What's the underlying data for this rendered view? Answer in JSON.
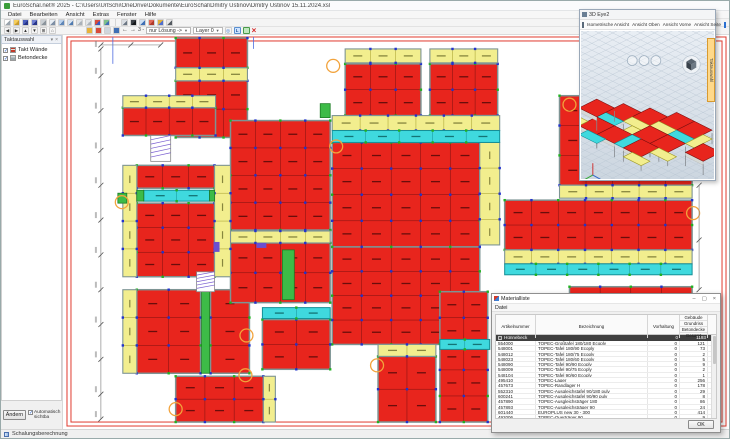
{
  "window": {
    "title": "EuroSchal.net® 2025 - C:\\Users\\UrlSchi\\OneDrive\\Dokumente\\EuroSchal\\Dmitry Ustinov\\Dmitry Ustinov 15.11.2024.xsl"
  },
  "menu": {
    "items": [
      "Datei",
      "Bearbeiten",
      "Ansicht",
      "Extras",
      "Fenster",
      "Hilfe"
    ]
  },
  "toolbar1": {
    "icons": [
      {
        "name": "new-file-icon",
        "c1": "#ffffff",
        "c2": "#9aa4ad"
      },
      {
        "name": "open-folder-icon",
        "c1": "#f7cf5e",
        "c2": "#c89a2a"
      },
      {
        "name": "save-icon",
        "c1": "#4a5fbe",
        "c2": "#27358a"
      },
      {
        "name": "save-all-icon",
        "c1": "#6f7fd0",
        "c2": "#27358a"
      },
      {
        "name": "print-icon",
        "c1": "#c9ced3",
        "c2": "#8b949c"
      },
      {
        "name": "print-preview-icon",
        "c1": "#e8eef4",
        "c2": "#7d8fa5"
      },
      {
        "name": "page-setup-icon",
        "c1": "#bcd3ee",
        "c2": "#5f86b8"
      },
      {
        "name": "export-icon",
        "c1": "#d7e2ef",
        "c2": "#4f7ab0"
      },
      {
        "name": "undo-icon",
        "c1": "#e3e6e9",
        "c2": "#aab2ba"
      },
      {
        "name": "redo-icon",
        "c1": "#e3e6e9",
        "c2": "#aab2ba"
      },
      {
        "name": "format-paint-icon",
        "c1": "#d94a3a",
        "c2": "#3a58c0"
      },
      {
        "name": "insert-image-icon",
        "c1": "#7fc08a",
        "c2": "#3f6fb5"
      },
      {
        "name": "sep",
        "c1": "",
        "c2": ""
      },
      {
        "name": "measure-icon",
        "c1": "#d9dde2",
        "c2": "#6b7683"
      },
      {
        "name": "select-cursor-icon",
        "c1": "#3a3f45",
        "c2": "#14171a"
      },
      {
        "name": "dimension-icon",
        "c1": "#cfe0f2",
        "c2": "#3f6fb5"
      },
      {
        "name": "snap-point-icon",
        "c1": "#e06a5a",
        "c2": "#b03a2a"
      },
      {
        "name": "takt-table-icon",
        "c1": "#e0b23a",
        "c2": "#4f6fd0"
      },
      {
        "name": "zoom-icon",
        "c1": "#e8e8e8",
        "c2": "#555b61"
      }
    ]
  },
  "toolbar2": {
    "nav_icons": [
      {
        "name": "pan-left-icon",
        "g": "◀"
      },
      {
        "name": "pan-right-icon",
        "g": "▶"
      },
      {
        "name": "pan-up-icon",
        "g": "▲"
      },
      {
        "name": "pan-down-icon",
        "g": "▼"
      },
      {
        "name": "zoom-window-icon",
        "g": "⊞"
      },
      {
        "name": "zoom-all-icon",
        "g": "⌂"
      }
    ],
    "takt_icons": [
      {
        "name": "takt-walls-icon",
        "c": "#e8b23a"
      },
      {
        "name": "takt-slab-icon",
        "c": "#d94a3a"
      },
      {
        "name": "pause-icon",
        "c": "#cfd6dd"
      },
      {
        "name": "view-mode-icon",
        "c": "#3f6fb5"
      }
    ],
    "prev_label": "←",
    "next_label": "→",
    "mode_label": "3 -",
    "solution_dropdown": "nur Lösung ->",
    "layer_dropdown": "Layer 0",
    "target_glyph": "◎",
    "solution_toggle": "L",
    "close_glyph": "×"
  },
  "sidebar": {
    "title": "Taktauswahl",
    "pin_glyph": "▾",
    "close_glyph": "×",
    "items": [
      {
        "label": "Takt Wände",
        "icon": "wall-icon",
        "checked": "✓"
      },
      {
        "label": "Betondecke",
        "icon": "slab-icon",
        "checked": "✓"
      }
    ],
    "change_button": "Ändern",
    "auto_checkbox": "Automatisch sichtba",
    "auto_checked": "✓"
  },
  "statusbar": {
    "text": "Schalungsberechnung"
  },
  "viewer3d": {
    "title": "3D Eye2",
    "toolbar": [
      "Isometrische Ansicht",
      "Ansicht Oben",
      "Ansicht Vorne",
      "Ansicht Seite"
    ],
    "side_tab": "Taktauswahl"
  },
  "materials": {
    "title": "Materialliste",
    "controls": {
      "min": "–",
      "max": "▢",
      "close": "×"
    },
    "menu": "Datei",
    "columns": {
      "art": "Artikelnummer",
      "bez": "Bezeichnung",
      "vor": "Vorhaltung"
    },
    "stacked_header": [
      "Gebäude",
      "Grundriss",
      "Betondecke",
      "Gesamt"
    ],
    "group": {
      "name": "Hünnebeck",
      "vorhaltung": "0",
      "gesamt": "1193"
    },
    "rows": [
      [
        "554000",
        "TOPEC-Großtafel 180/180 Ecoply",
        "0",
        "121"
      ],
      [
        "548001",
        "TOPEC-Tafel 180/90 Ecoply",
        "0",
        "73"
      ],
      [
        "548012",
        "TOPEC-Tafel 180/75 Ecoply",
        "0",
        "2"
      ],
      [
        "548023",
        "TOPEC-Tafel 180/60 Ecoply",
        "0",
        "5"
      ],
      [
        "548090",
        "TOPEC-Tafel 90/90 Ecoply",
        "0",
        "9"
      ],
      [
        "548009",
        "TOPEC-Tafel 90/75 Ecoply",
        "0",
        "2"
      ],
      [
        "548104",
        "TOPEC-Tafel 90/60 Ecoply",
        "0",
        "1"
      ],
      [
        "495410",
        "TOPEC-Lager",
        "0",
        "256"
      ],
      [
        "457673",
        "TOPEC-Randlager H",
        "0",
        "178"
      ],
      [
        "552310",
        "TOPEC-Ausgleichstafel 90/180 pulv",
        "0",
        "29"
      ],
      [
        "600241",
        "TOPEC-Ausgleichstafel 90/90 pulv",
        "0",
        "8"
      ],
      [
        "457890",
        "TOPEC-Ausgleichsträger 180",
        "0",
        "86"
      ],
      [
        "457893",
        "TOPEC-Ausgleichsträger 90",
        "0",
        "24"
      ],
      [
        "601440",
        "EUROPLUS new 30 - 300",
        "0",
        "414"
      ],
      [
        "492006",
        "TOPEC-Querträger 90",
        "0",
        "9"
      ]
    ],
    "ok": "OK"
  },
  "colors": {
    "red": "#e8251d",
    "redBorder": "#7a1010",
    "smudgeRed": "#4a0808",
    "yellow": "#f2ee8e",
    "yellowBorder": "#a09a28",
    "smudgeYellow": "#6b6b2a",
    "cyan": "#3fd9de",
    "cyanBorder": "#148f96",
    "smudgeCyan": "#0a5a5a",
    "green": "#3dbb47",
    "greenBorder": "#1d7d24",
    "wall": "#7d9494",
    "frame": "#e03a2e",
    "dotBlue": "#2233cc",
    "dotGreen": "#21b121",
    "orange": "#f2a33c",
    "purple": "#6a4fd0",
    "dim": "#8a8a8a"
  },
  "plan": {
    "frame": [
      [
        66,
        36,
        661,
        391
      ],
      [
        70,
        40,
        653,
        383
      ]
    ],
    "red_grids": [
      [
        175,
        37,
        72,
        30,
        3,
        1
      ],
      [
        175,
        80,
        72,
        57,
        3,
        2
      ],
      [
        122,
        107,
        93,
        28,
        4,
        1
      ],
      [
        136,
        165,
        78,
        23,
        3,
        1
      ],
      [
        136,
        203,
        78,
        74,
        3,
        3
      ],
      [
        136,
        290,
        64,
        84,
        2,
        3
      ],
      [
        210,
        290,
        39,
        84,
        1,
        3
      ],
      [
        230,
        120,
        100,
        110,
        4,
        4
      ],
      [
        230,
        243,
        100,
        60,
        4,
        2
      ],
      [
        175,
        377,
        88,
        46,
        3,
        2
      ],
      [
        345,
        63,
        76,
        52,
        3,
        2
      ],
      [
        430,
        63,
        68,
        52,
        3,
        2
      ],
      [
        332,
        142,
        148,
        105,
        5,
        4
      ],
      [
        332,
        247,
        148,
        98,
        5,
        4
      ],
      [
        378,
        357,
        58,
        66,
        2,
        2
      ],
      [
        440,
        292,
        48,
        131,
        2,
        5
      ],
      [
        560,
        95,
        133,
        90,
        5,
        3
      ],
      [
        505,
        200,
        188,
        50,
        7,
        2
      ],
      [
        570,
        287,
        123,
        56,
        4,
        2
      ],
      [
        262,
        320,
        68,
        50,
        2,
        2
      ]
    ],
    "yellow_strips": [
      [
        175,
        67,
        72,
        13,
        3,
        0
      ],
      [
        122,
        95,
        93,
        12,
        4,
        0
      ],
      [
        122,
        165,
        14,
        112,
        4,
        1
      ],
      [
        122,
        290,
        14,
        84,
        3,
        1
      ],
      [
        345,
        48,
        76,
        14,
        3,
        0
      ],
      [
        430,
        48,
        68,
        14,
        3,
        0
      ],
      [
        332,
        115,
        168,
        15,
        6,
        0
      ],
      [
        480,
        142,
        20,
        103,
        4,
        1
      ],
      [
        505,
        250,
        188,
        14,
        7,
        0
      ],
      [
        560,
        185,
        133,
        13,
        5,
        0
      ],
      [
        378,
        345,
        58,
        12,
        2,
        0
      ],
      [
        263,
        377,
        12,
        46,
        2,
        1
      ],
      [
        230,
        231,
        100,
        12,
        4,
        0
      ],
      [
        214,
        165,
        16,
        112,
        4,
        1
      ]
    ],
    "cyan_strips": [
      [
        332,
        130,
        168,
        12,
        5,
        0
      ],
      [
        505,
        264,
        188,
        11,
        6,
        0
      ],
      [
        143,
        190,
        66,
        11,
        2,
        0
      ],
      [
        440,
        340,
        50,
        10,
        2,
        0
      ],
      [
        262,
        308,
        68,
        11,
        2,
        0
      ]
    ],
    "green_rects": [
      [
        201,
        290,
        8,
        84
      ],
      [
        282,
        250,
        12,
        50
      ],
      [
        136,
        190,
        7,
        11
      ],
      [
        209,
        190,
        5,
        11
      ],
      [
        117,
        193,
        9,
        10
      ],
      [
        320,
        103,
        10,
        14
      ]
    ],
    "purple_rects": [
      [
        213,
        242,
        6,
        10
      ],
      [
        256,
        243,
        10,
        5
      ]
    ],
    "stairs": [
      [
        150,
        135,
        20,
        26
      ],
      [
        196,
        272,
        18,
        20
      ]
    ],
    "circles": [
      [
        333,
        65
      ],
      [
        336,
        146
      ],
      [
        570,
        104
      ],
      [
        694,
        213
      ],
      [
        246,
        336
      ],
      [
        245,
        376
      ],
      [
        175,
        410
      ],
      [
        377,
        366
      ],
      [
        121,
        202
      ]
    ],
    "dims": {
      "vx": 100,
      "vy1": 48,
      "vy2": 420,
      "vticks": [
        48,
        75,
        110,
        150,
        185,
        220,
        255,
        290,
        325,
        360,
        395,
        420
      ],
      "hy": 44,
      "hx1": 100,
      "hx2": 160,
      "hticks": [
        100,
        130,
        160
      ],
      "v2x": 700,
      "v2y1": 185,
      "v2y2": 290,
      "v2ticks": [
        185,
        240,
        290
      ]
    },
    "helper_lines": [
      [
        112,
        36,
        112,
        63
      ],
      [
        253,
        36,
        253,
        48
      ]
    ]
  },
  "scene3d": {
    "origin": [
      70,
      96
    ],
    "ex": [
      9,
      4.5
    ],
    "ey": [
      -9,
      4.5
    ],
    "tiles": [
      [
        -4,
        -1,
        2,
        2,
        "r"
      ],
      [
        -2,
        -2,
        2,
        2,
        "r"
      ],
      [
        0,
        -3,
        2,
        2,
        "r"
      ],
      [
        2,
        -3,
        2,
        2,
        "r"
      ],
      [
        -2,
        0,
        2,
        1,
        "y"
      ],
      [
        0,
        -1,
        2,
        1,
        "y"
      ],
      [
        2,
        -1,
        3,
        1,
        "c"
      ],
      [
        -4,
        1,
        2,
        1,
        "c"
      ],
      [
        -1,
        1,
        1,
        3,
        "y"
      ],
      [
        0,
        0,
        2,
        2,
        "r"
      ],
      [
        2,
        0,
        2,
        2,
        "r"
      ],
      [
        -4,
        2,
        2,
        2,
        "r"
      ],
      [
        -2,
        2,
        2,
        2,
        "r"
      ],
      [
        0,
        2,
        1,
        2,
        "c"
      ],
      [
        1,
        2,
        2,
        2,
        "r"
      ],
      [
        3,
        2,
        2,
        1,
        "y"
      ],
      [
        4,
        -2,
        1,
        2,
        "y"
      ],
      [
        5,
        -1,
        2,
        2,
        "r"
      ],
      [
        -6,
        0,
        2,
        2,
        "r"
      ],
      [
        -6,
        3,
        2,
        1,
        "y"
      ],
      [
        2,
        4,
        2,
        1,
        "y"
      ],
      [
        -3,
        4,
        2,
        1,
        "c"
      ]
    ],
    "cube": [
      112,
      34
    ],
    "axis": [
      12,
      146
    ],
    "ghosts": [
      [
        52,
        30
      ],
      [
        64,
        30
      ],
      [
        76,
        30
      ]
    ]
  }
}
